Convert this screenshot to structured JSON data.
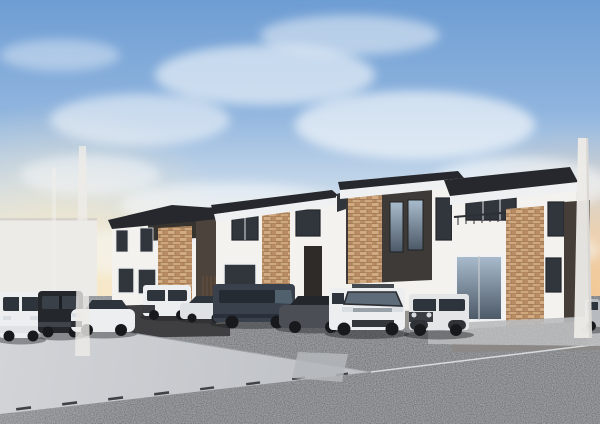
{
  "scene": {
    "type": "architectural-cg-rendering",
    "subject": "Row of four newly built two-story houses with a line of parked cars along a wide street",
    "style": "photorealistic exterior perspective from street level",
    "lighting": "dusk sky with wispy clouds and warm sunset glow at the horizon"
  },
  "sky": {
    "clouds": "wispy diagonal cirrus band from upper left to mid right",
    "gradient_top": "#6e9dd3",
    "gradient_horizon": "#f6e5c4",
    "sunset_glow_left": "#f8e9c6",
    "sunset_glow_right": "#f2c089"
  },
  "colors": {
    "bg_wall": "#ecebe7",
    "wall_white": "#f4f2ee",
    "wall_shade": "#dedbd6",
    "fascia_white": "#eff0f1",
    "roof_dark": "#26282d",
    "recess_dark": "#37332f",
    "panel_brown": "#4c433c",
    "panel_brown_deep": "#453d37",
    "panel_charcoal": "#3e3a37",
    "door_wood": "#5a4a3d",
    "door_recess": "#2f2b28",
    "window_dark": "#31363d",
    "foundation_gray": "#97948f",
    "foundation_warm": "#8b8885",
    "base_dark": "#3f3e40",
    "pole_white": "#edebe7",
    "road_light": "#c9ccd1",
    "asphalt_dark": "#5f6267",
    "apron_light": "#a9aaac",
    "pad_light": "#b4b7bb",
    "seam_light": "#d8dade",
    "shadow": "#1c1e22",
    "car_white": "#eceef0",
    "car_white_dim": "#dfe2e5",
    "car_dark": "#24272c",
    "car_navy": "#39414c",
    "car_gray": "#4b4f55",
    "car_silver": "#b7bbc0",
    "glass_dark": "#2e343b",
    "glass_blue": "#5e6b78",
    "bumper_dark": "#33363a",
    "tire": "#17191c",
    "headlight": "#d9dee3",
    "distant_wall": "#b3b1ae",
    "brick_base": "#c59a73",
    "brick_dark": "#9a744f",
    "brick_light": "#d2ab82"
  },
  "houses": [
    {
      "id": "house-1",
      "position": "far left",
      "storeys": 2,
      "walls": "white",
      "roof": "dark flat parapet roof",
      "features": [
        "recessed dark balcony",
        "brick accent pier",
        "dark brown entrance panel",
        "wood-slat door",
        "two lower windows"
      ]
    },
    {
      "id": "house-2",
      "position": "center left",
      "storeys": 2,
      "walls": "white",
      "roof": "dark coping over white fascia",
      "features": [
        "full-height brick pier",
        "paired upper windows",
        "wide lower window",
        "recessed dark entrance"
      ]
    },
    {
      "id": "house-3",
      "position": "center right",
      "storeys": 2,
      "walls": "white with dark charcoal feature wall",
      "roof": "dark coping over white fascia",
      "features": [
        "brick pier",
        "two tall sky-reflecting windows",
        "white side wing"
      ]
    },
    {
      "id": "house-4",
      "position": "far right, closest to camera",
      "storeys": 2,
      "walls": "white",
      "roof": "dark coping over white fascia",
      "features": [
        "balcony railing",
        "large full-height brick pier",
        "glass entrance opening",
        "dark brown side panel"
      ]
    }
  ],
  "vehicles": [
    {
      "id": "car-1",
      "type": "kei minivan",
      "color": "white",
      "position": "far left"
    },
    {
      "id": "car-2",
      "type": "boxy kei SUV",
      "color": "dark charcoal",
      "position": "left"
    },
    {
      "id": "car-3",
      "type": "sedan",
      "color": "white",
      "position": "left"
    },
    {
      "id": "car-4",
      "type": "boxy SUV",
      "color": "white",
      "position": "center left"
    },
    {
      "id": "car-5",
      "type": "sedan",
      "color": "white",
      "position": "center, partly hidden"
    },
    {
      "id": "car-6",
      "type": "minivan",
      "color": "dark blue-gray",
      "position": "center"
    },
    {
      "id": "car-7",
      "type": "hatchback sedan",
      "color": "dark gray",
      "position": "center right"
    },
    {
      "id": "car-8",
      "type": "minivan",
      "color": "white",
      "position": "right"
    },
    {
      "id": "car-9",
      "type": "boxy kei SUV",
      "color": "white-silver",
      "position": "right"
    },
    {
      "id": "car-10",
      "type": "compact car",
      "color": "silver",
      "position": "far right edge, partially cropped"
    }
  ],
  "environment": {
    "foreground": "wide street sweeping diagonally; smooth sunlit roadway on the left, dark speckled asphalt pavement elsewhere",
    "background_left": "plain light gray wall",
    "utility_poles": 3,
    "road_markings": "gutter seam with drainage joints running diagonally across the road"
  }
}
